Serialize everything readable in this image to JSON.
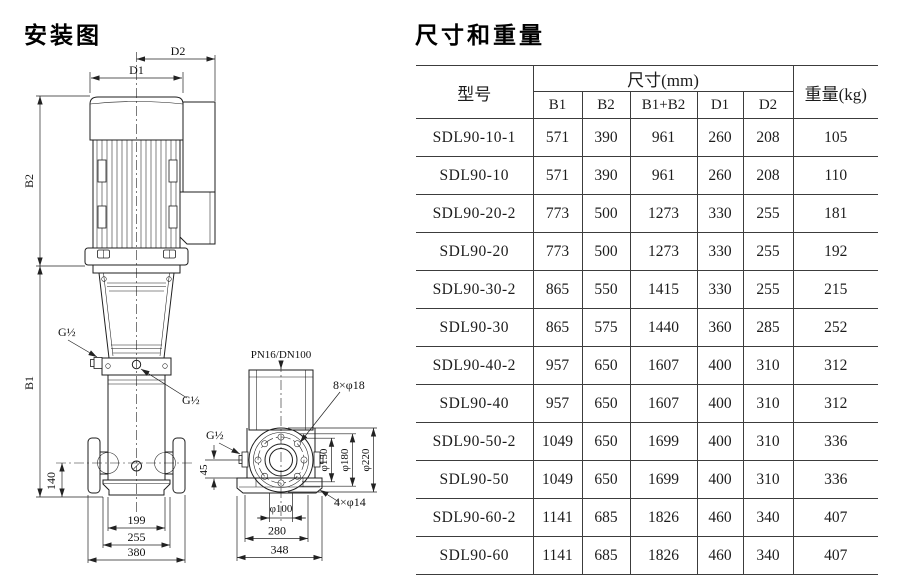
{
  "drawing": {
    "title": "安装图",
    "front_view": {
      "dim_d1": "D1",
      "dim_d2": "D2",
      "dim_b1": "B1",
      "dim_b2": "B2",
      "port_thread_upper": "G½",
      "port_thread_lower": "G½",
      "dim_140": "140",
      "dim_199": "199",
      "dim_255": "255",
      "dim_380": "380"
    },
    "side_view": {
      "flange_spec": "PN16/DN100",
      "bolt_holes": "8×φ18",
      "port_thread": "G½",
      "dim_45": "45",
      "dia_150": "φ150",
      "dia_180": "φ180",
      "dia_220": "φ220",
      "dia_100": "φ100",
      "foot_holes": "4×φ14",
      "dim_280": "280",
      "dim_348": "348"
    }
  },
  "table": {
    "title": "尺寸和重量",
    "header": {
      "model": "型号",
      "size_group": "尺寸(mm)",
      "size_columns": [
        "B1",
        "B2",
        "B1+B2",
        "D1",
        "D2"
      ],
      "weight": "重量(kg)"
    },
    "rows": [
      [
        "SDL90-10-1",
        "571",
        "390",
        "961",
        "260",
        "208",
        "105"
      ],
      [
        "SDL90-10",
        "571",
        "390",
        "961",
        "260",
        "208",
        "110"
      ],
      [
        "SDL90-20-2",
        "773",
        "500",
        "1273",
        "330",
        "255",
        "181"
      ],
      [
        "SDL90-20",
        "773",
        "500",
        "1273",
        "330",
        "255",
        "192"
      ],
      [
        "SDL90-30-2",
        "865",
        "550",
        "1415",
        "330",
        "255",
        "215"
      ],
      [
        "SDL90-30",
        "865",
        "575",
        "1440",
        "360",
        "285",
        "252"
      ],
      [
        "SDL90-40-2",
        "957",
        "650",
        "1607",
        "400",
        "310",
        "312"
      ],
      [
        "SDL90-40",
        "957",
        "650",
        "1607",
        "400",
        "310",
        "312"
      ],
      [
        "SDL90-50-2",
        "1049",
        "650",
        "1699",
        "400",
        "310",
        "336"
      ],
      [
        "SDL90-50",
        "1049",
        "650",
        "1699",
        "400",
        "310",
        "336"
      ],
      [
        "SDL90-60-2",
        "1141",
        "685",
        "1826",
        "460",
        "340",
        "407"
      ],
      [
        "SDL90-60",
        "1141",
        "685",
        "1826",
        "460",
        "340",
        "407"
      ]
    ]
  }
}
